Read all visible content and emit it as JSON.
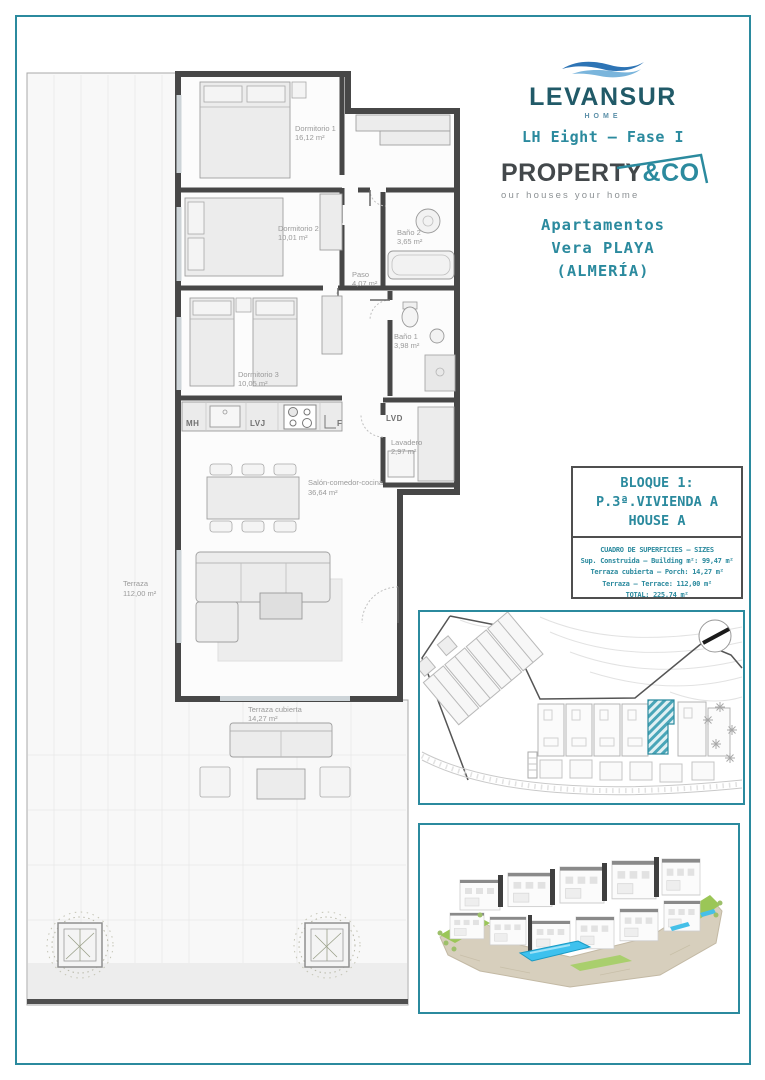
{
  "brand": {
    "name": "LEVANSUR",
    "tag": "HOME",
    "phase": "LH Eight – Fase I",
    "partner_name": "PROPERTY",
    "partner_suffix": "&CO",
    "partner_tagline": "our houses your home"
  },
  "project": {
    "type": "Apartamentos",
    "location": "Vera PLAYA",
    "province": "(ALMERÍA)"
  },
  "unit_info": {
    "block": "BLOQUE 1:",
    "unit": "P.3ª.VIVIENDA A",
    "house": "HOUSE A",
    "table_title": "CUADRO DE SUPERFICIES – SIZES",
    "rows": [
      "Sup. Construida – Building m²: 99,47 m²",
      "Terraza cubierta – Porch: 14,27 m²",
      "Terraza – Terrace: 112,00 m²",
      "TOTAL:  225,74 m²"
    ]
  },
  "floor_plan": {
    "rooms": [
      {
        "name": "Dormitorio 1",
        "area": "16,12 m²"
      },
      {
        "name": "Dormitorio 2",
        "area": "10,01 m²"
      },
      {
        "name": "Paso",
        "area": "4,07 m²"
      },
      {
        "name": "Baño 2",
        "area": "3,65 m²"
      },
      {
        "name": "Baño 1",
        "area": "3,98 m²"
      },
      {
        "name": "Dormitorio 3",
        "area": "10,05 m²"
      },
      {
        "name": "Lavadero",
        "area": "2,97 m²"
      },
      {
        "name": "Salón-comedor-cocina",
        "area": "36,64 m²"
      },
      {
        "name": "Terraza",
        "area": "112,00 m²"
      },
      {
        "name": "Terraza cubierta",
        "area": "14,27 m²"
      }
    ],
    "kitchen_labels": [
      "MH",
      "LVJ",
      "F"
    ],
    "laundry_label": "LVD"
  },
  "colors": {
    "accent_teal": "#2b8a9e",
    "brand_dark": "#215a68",
    "wave_blue": "#2d74b5",
    "wave_light": "#7ab5dc",
    "wall": "#474747",
    "room_label": "#9a9a9a",
    "pool_blue": "#3ec1ee",
    "lawn_green": "#9bc657",
    "site_highlight": "#49a5b8"
  }
}
